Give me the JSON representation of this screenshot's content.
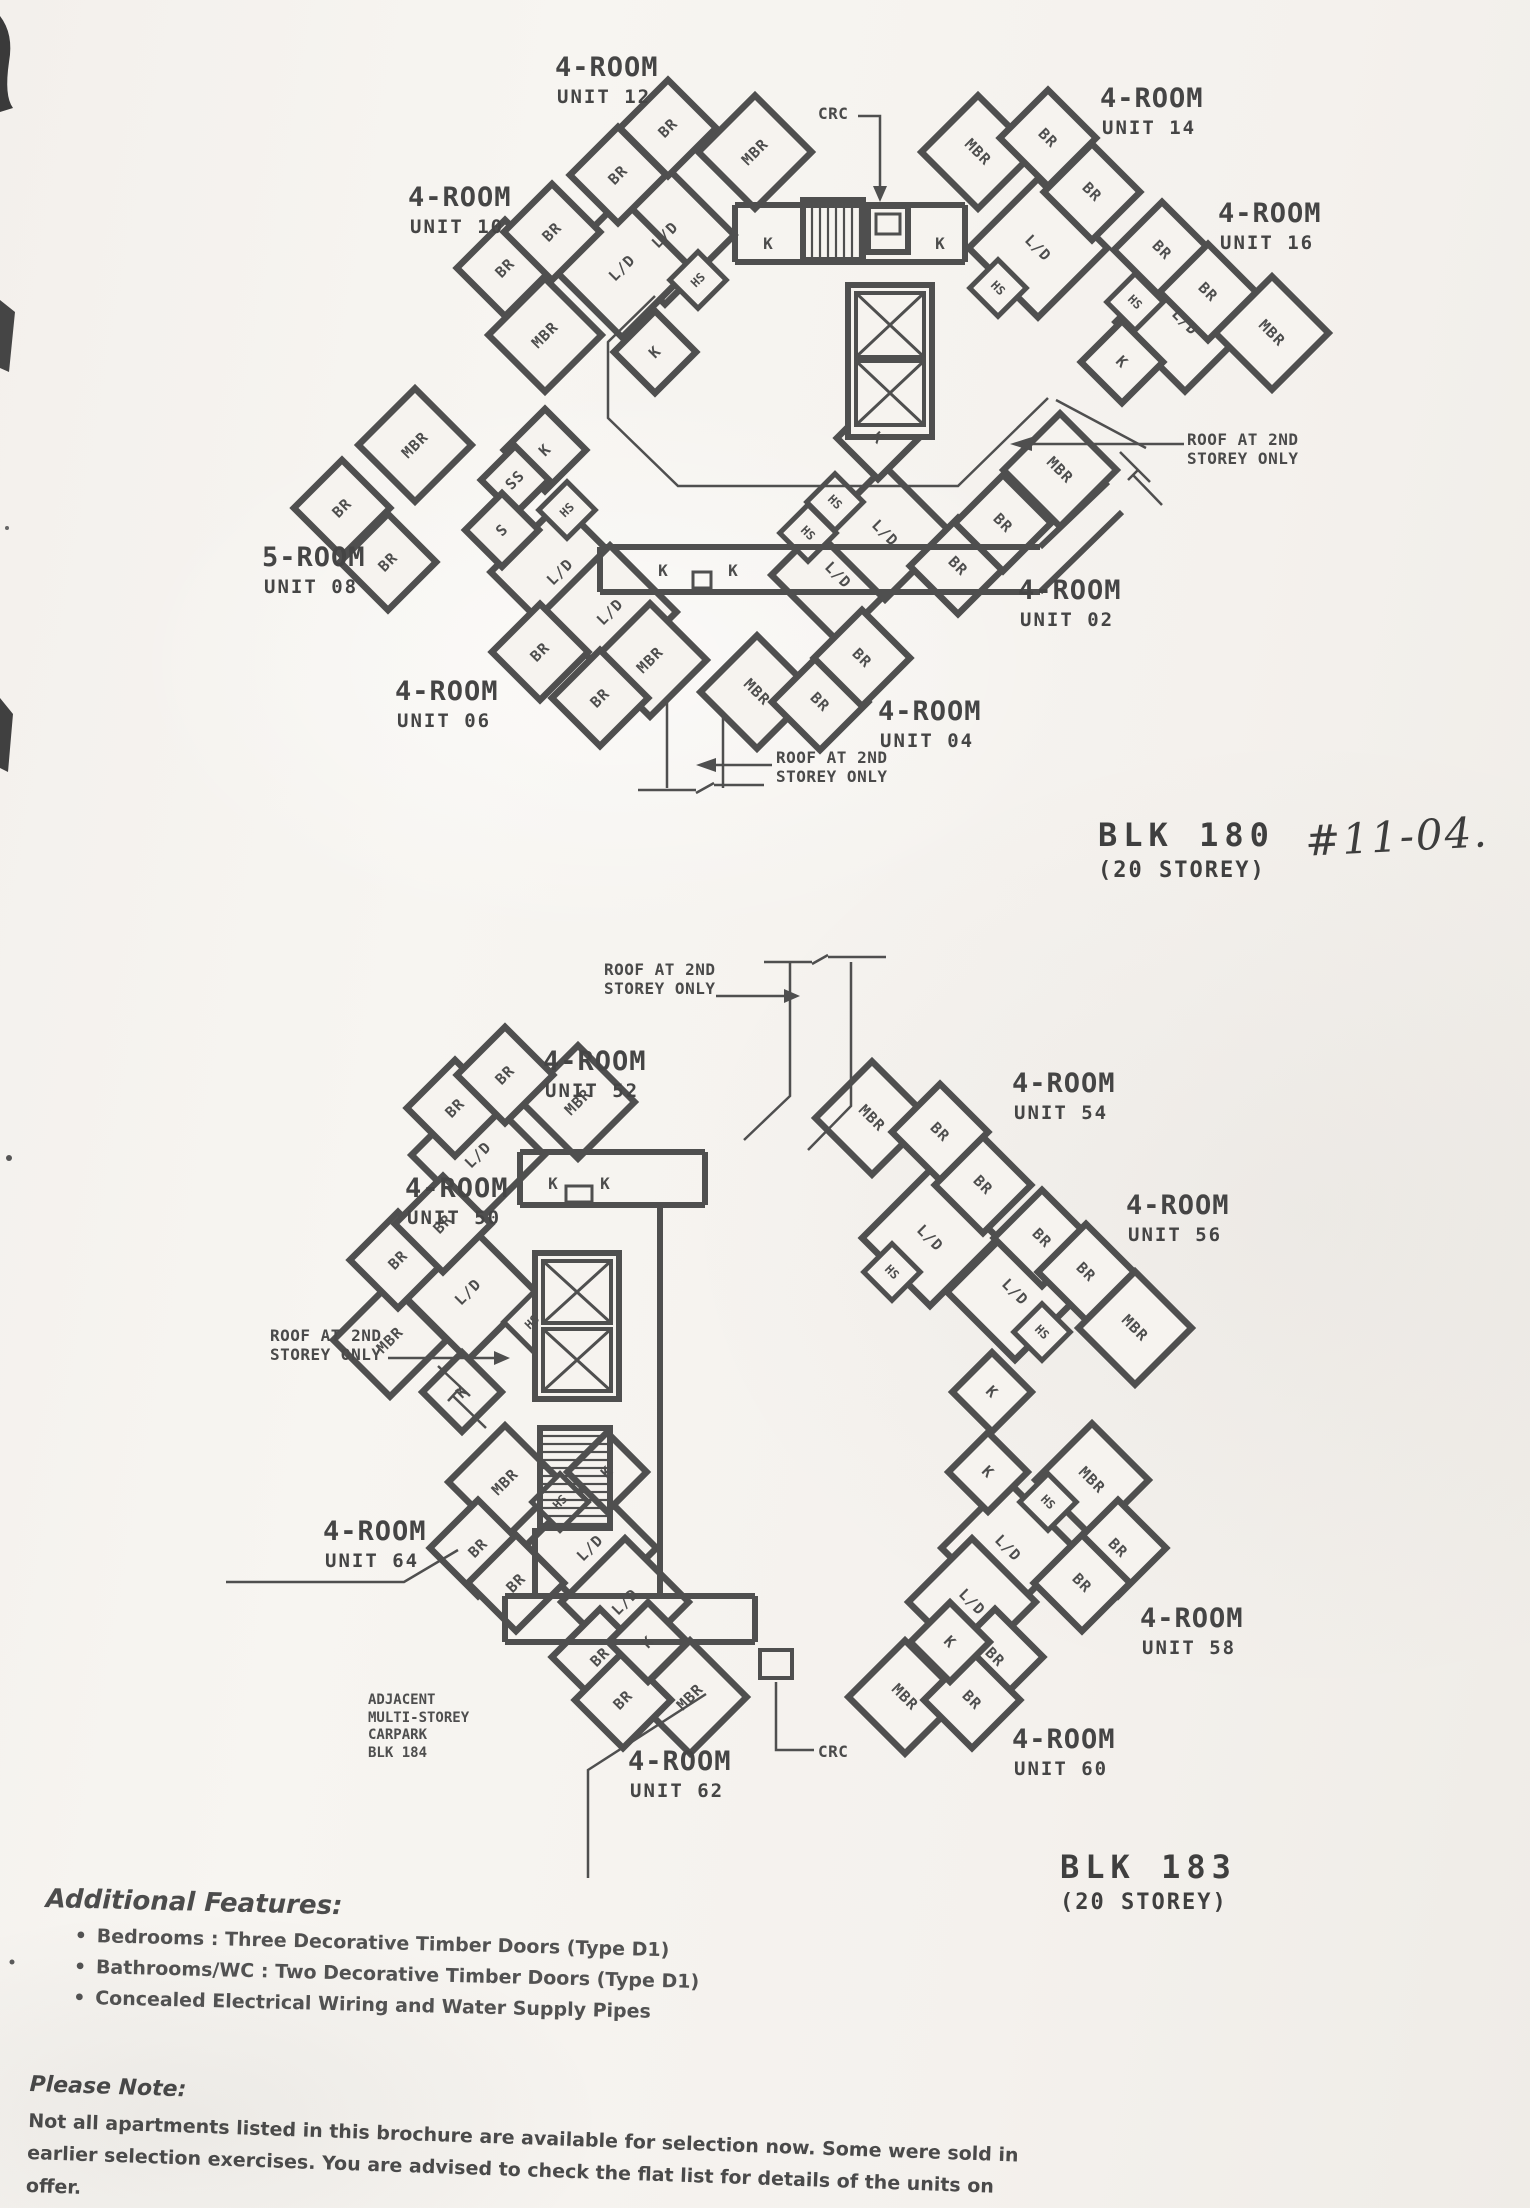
{
  "page": {
    "background": "#f5f2ee",
    "ink": "#4d4d4d"
  },
  "legend": {
    "br": "BR",
    "mbr": "MBR",
    "ld": "L/D",
    "k": "K",
    "hs": "HS",
    "ss": "SS",
    "s": "S"
  },
  "notes": {
    "crc": "CRC",
    "roof1": "ROOF AT 2ND",
    "roof2": "STOREY ONLY"
  },
  "carpark": {
    "line1": "ADJACENT",
    "line2": "MULTI-STOREY",
    "line3": "CARPARK",
    "line4": "BLK 184"
  },
  "blocks": [
    {
      "name": "BLK 180",
      "storeys": "(20 STOREY)",
      "handwritten": "#11-04."
    },
    {
      "name": "BLK 183",
      "storeys": "(20 STOREY)"
    }
  ],
  "plans": [
    {
      "units": [
        {
          "type": "4-ROOM",
          "unit": "UNIT 12"
        },
        {
          "type": "4-ROOM",
          "unit": "UNIT 10"
        },
        {
          "type": "4-ROOM",
          "unit": "UNIT 14"
        },
        {
          "type": "4-ROOM",
          "unit": "UNIT 16"
        },
        {
          "type": "5-ROOM",
          "unit": "UNIT 08"
        },
        {
          "type": "4-ROOM",
          "unit": "UNIT 02"
        },
        {
          "type": "4-ROOM",
          "unit": "UNIT 06"
        },
        {
          "type": "4-ROOM",
          "unit": "UNIT 04"
        }
      ]
    },
    {
      "units": [
        {
          "type": "4-ROOM",
          "unit": "UNIT 52"
        },
        {
          "type": "4-ROOM",
          "unit": "UNIT 54"
        },
        {
          "type": "4-ROOM",
          "unit": "UNIT 50"
        },
        {
          "type": "4-ROOM",
          "unit": "UNIT 56"
        },
        {
          "type": "4-ROOM",
          "unit": "UNIT 64"
        },
        {
          "type": "4-ROOM",
          "unit": "UNIT 58"
        },
        {
          "type": "4-ROOM",
          "unit": "UNIT 62"
        },
        {
          "type": "4-ROOM",
          "unit": "UNIT 60"
        }
      ]
    }
  ],
  "features": {
    "title": "Additional Features:",
    "items": [
      "Bedrooms : Three Decorative Timber Doors (Type D1)",
      "Bathrooms/WC : Two Decorative Timber Doors (Type D1)",
      "Concealed Electrical Wiring and Water Supply Pipes"
    ]
  },
  "please_note": {
    "title": "Please Note:",
    "line1": "Not all apartments listed in this brochure are available for selection now. Some were sold in",
    "line2": "earlier selection exercises. You are advised to check the flat list for details of the units on offer."
  }
}
